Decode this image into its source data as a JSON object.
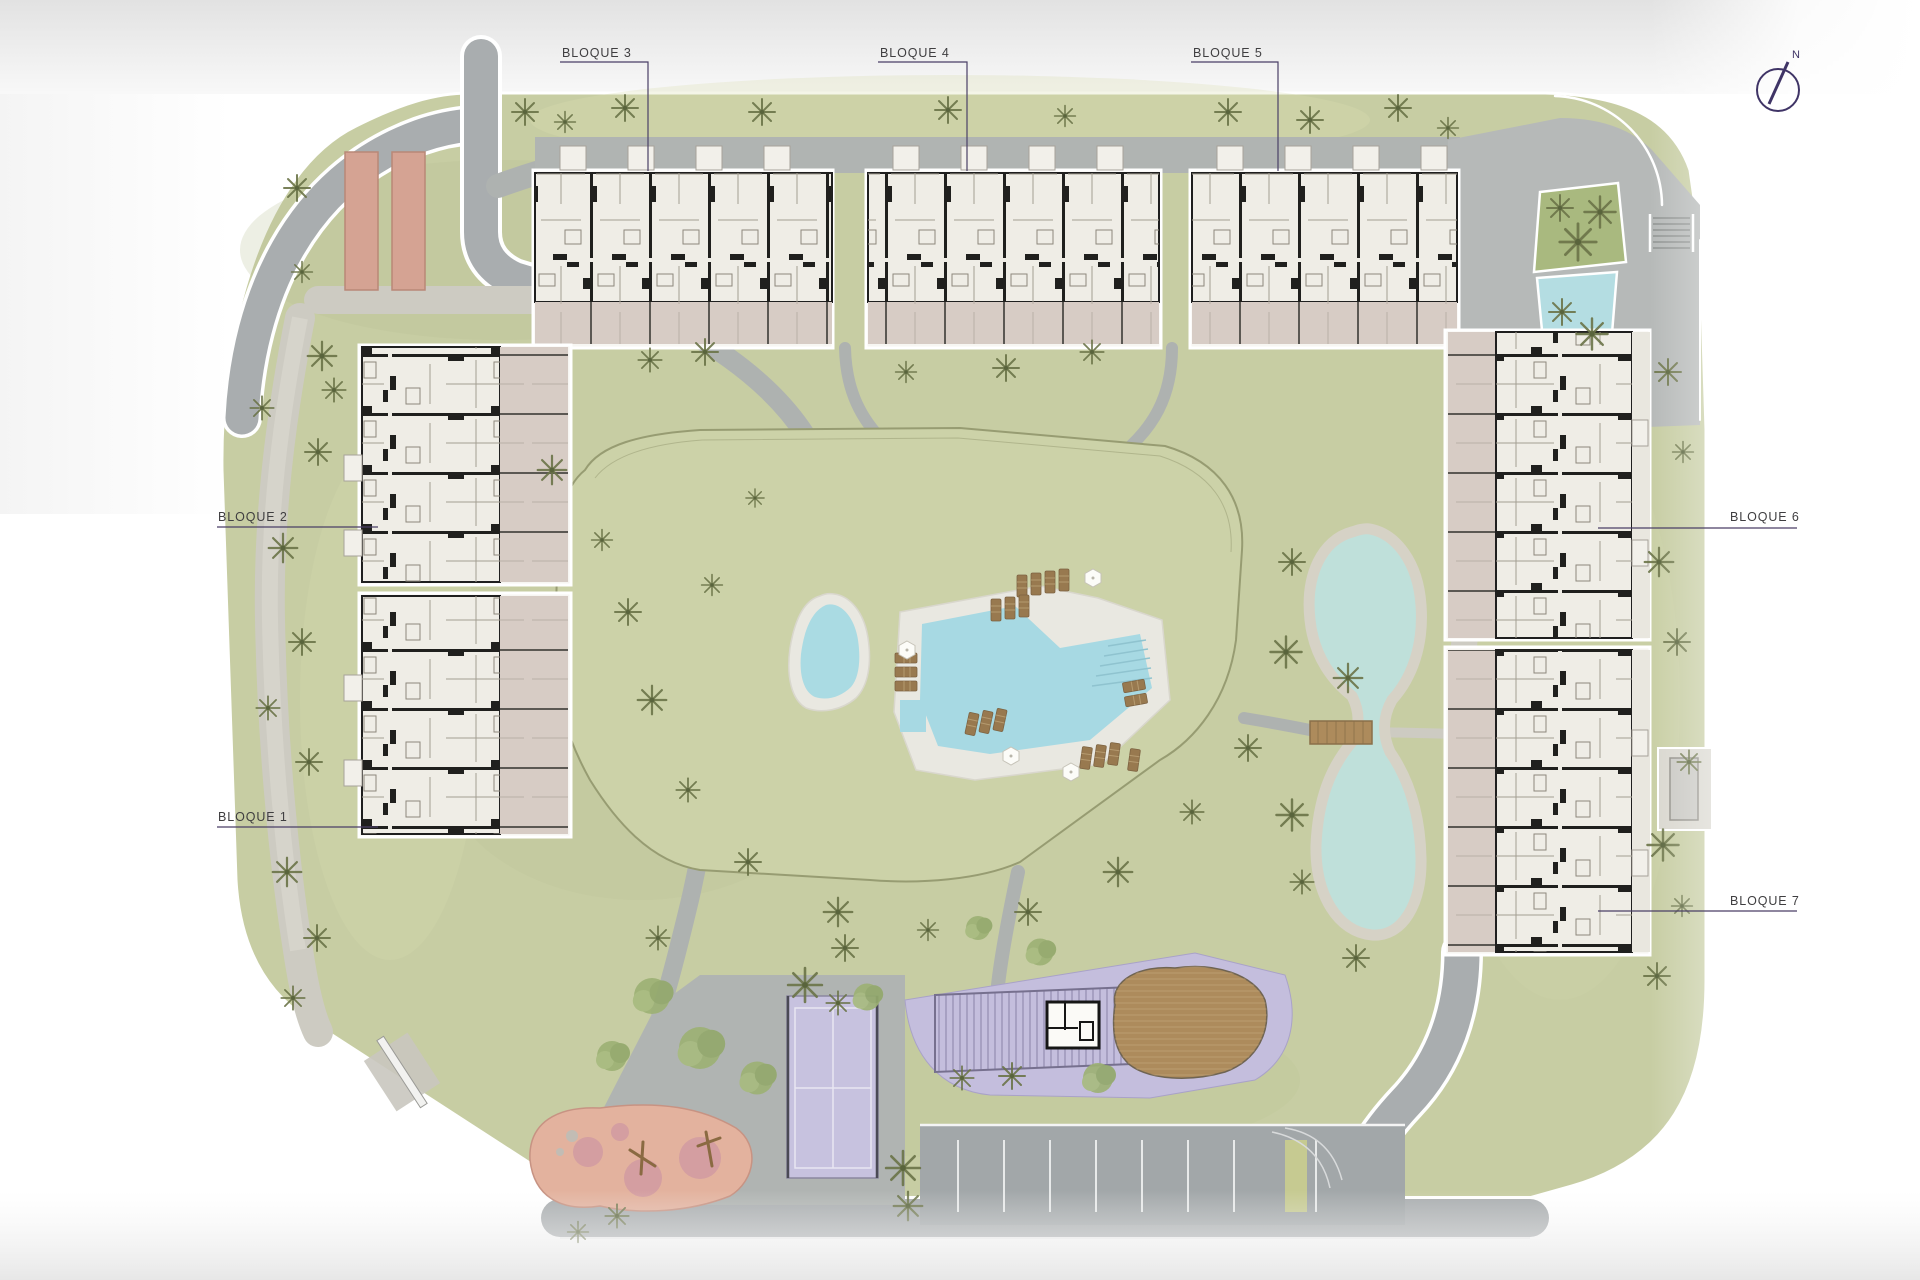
{
  "plan": {
    "compass": {
      "north_label": "N"
    },
    "labels": {
      "bloque1": "BLOQUE 1",
      "bloque2": "BLOQUE 2",
      "bloque3": "BLOQUE 3",
      "bloque4": "BLOQUE 4",
      "bloque5": "BLOQUE 5",
      "bloque6": "BLOQUE 6",
      "bloque7": "BLOQUE 7"
    },
    "icons": {
      "north-arrow-icon": "circle with tilted needle toward N",
      "umbrella-icon": "white hexagon",
      "sun-lounger-icon": "brown slatted rectangle",
      "palm-tree-icon": "radial olive fronds",
      "bush-icon": "green circle cluster",
      "bridge-icon": "wooden plank rectangle over pond"
    },
    "colors": {
      "page_bg": "#ffffff",
      "top_band": "#e4e4e4",
      "lawn": "#c7cda3",
      "mound_lawn": "#ccd2a8",
      "path_gray": "#aeb2b0",
      "pebble_path": "#cdcbc2",
      "plaza_gray": "#b6b9b8",
      "road_gray": "#a9adaf",
      "parking_gray": "#a2a7a9",
      "deck": "#e9e8e1",
      "pool_water": "#a7d9e3",
      "kids_pool_water": "#aadbe3",
      "pond_water": "#bfe0da",
      "pond_stone": "#d6d2c6",
      "feature_pool_water": "#b4dde2",
      "planter_green": "#a9b97f",
      "building_fill": "#efede6",
      "building_wall": "#1f1f1f",
      "terrace": "#d7ccc5",
      "purple_zone": "#c4bedd",
      "court_purple": "#c7c2df",
      "court_line": "#e8e6f2",
      "playground_base": "#e3b29e",
      "playground_spot": "#cf98a2",
      "carport": "#d5a393",
      "wood": "#ad8b5c",
      "lounger_wood": "#98794f",
      "label_text": "#3f3e40",
      "leader_line": "#4a3f66",
      "compass": "#3f3466"
    }
  }
}
